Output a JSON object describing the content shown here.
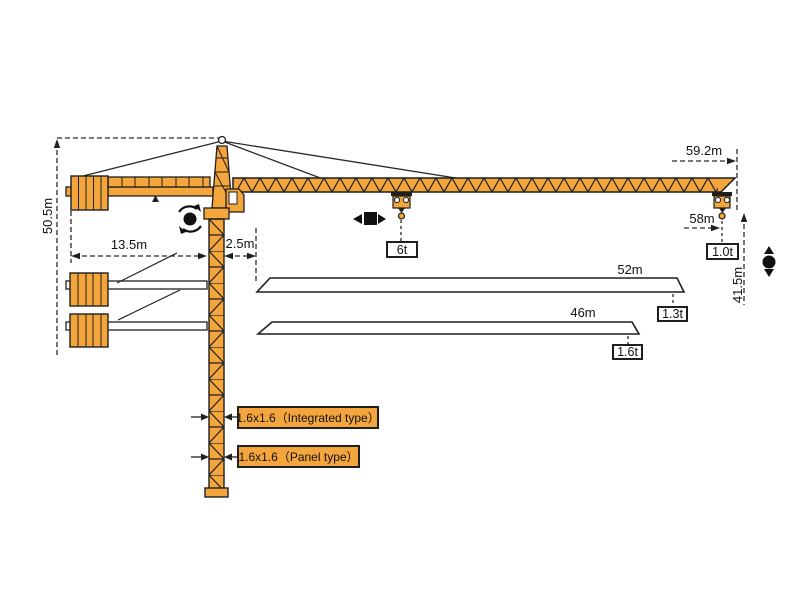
{
  "diagram": {
    "name": "tower-crane-dimension-diagram",
    "colors": {
      "crane_orange": "#F4A53B",
      "outline": "#1f1f1f",
      "dim_line": "#2b2b2b"
    },
    "dims": {
      "overall_height": "50.5m",
      "counter_jib_radius": "13.5m",
      "slew_offset": "2.5m",
      "max_jib_radius": "59.2m",
      "hook_radius": "58m",
      "hook_height": "41.5m"
    },
    "loads": {
      "mid_jib": "6t",
      "jib_tip": "1.0t"
    },
    "jib_variants": [
      {
        "length": "52m",
        "tip_load": "1.3t"
      },
      {
        "length": "46m",
        "tip_load": "1.6t"
      }
    ],
    "mast_types": [
      {
        "label": "1.6x1.6（Integrated type）"
      },
      {
        "label": "1.6x1.6（Panel type）"
      }
    ],
    "symbols": {
      "slewing": "slewing-rotation",
      "trolley": "trolley-travel",
      "hoist": "load-hoisting"
    }
  }
}
